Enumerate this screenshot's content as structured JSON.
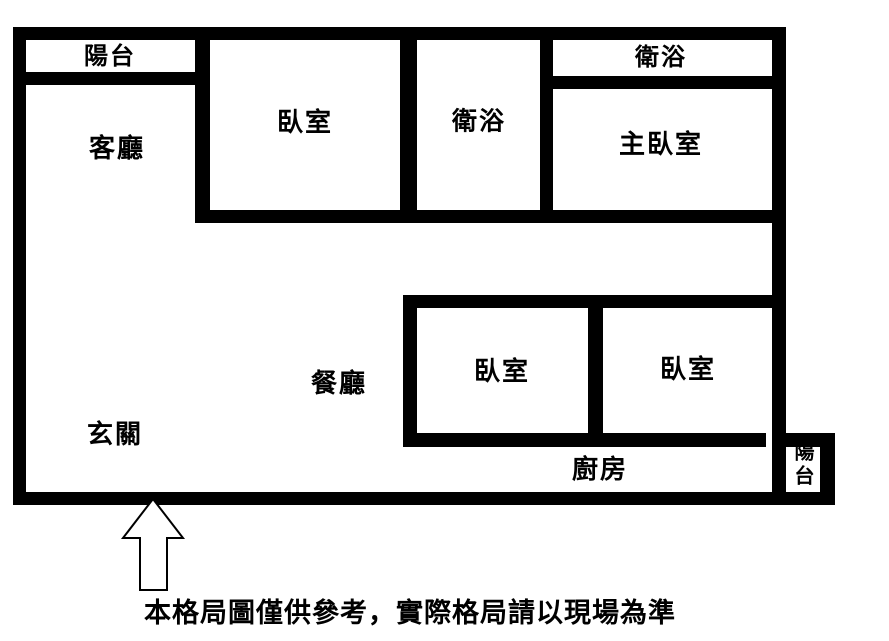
{
  "window": {
    "width": 889,
    "height": 641,
    "background": "#ffffff"
  },
  "floor_plan": {
    "wall_color": "#000000",
    "label_color": "#000000",
    "rooms": [
      {
        "id": "balcony-top",
        "label": "陽台"
      },
      {
        "id": "living-room",
        "label": "客廳"
      },
      {
        "id": "bedroom-top",
        "label": "臥室"
      },
      {
        "id": "bathroom-middle",
        "label": "衛浴"
      },
      {
        "id": "bathroom-top-right",
        "label": "衛浴"
      },
      {
        "id": "master-bedroom",
        "label": "主臥室"
      },
      {
        "id": "dining-room",
        "label": "餐廳"
      },
      {
        "id": "bedroom-lower-left",
        "label": "臥室"
      },
      {
        "id": "bedroom-lower-right",
        "label": "臥室"
      },
      {
        "id": "entrance",
        "label": "玄關"
      },
      {
        "id": "kitchen",
        "label": "廚房"
      },
      {
        "id": "balcony-bottom-right",
        "label": "陽台"
      }
    ],
    "caption": "本格局圖僅供參考，實際格局請以現場為準"
  }
}
